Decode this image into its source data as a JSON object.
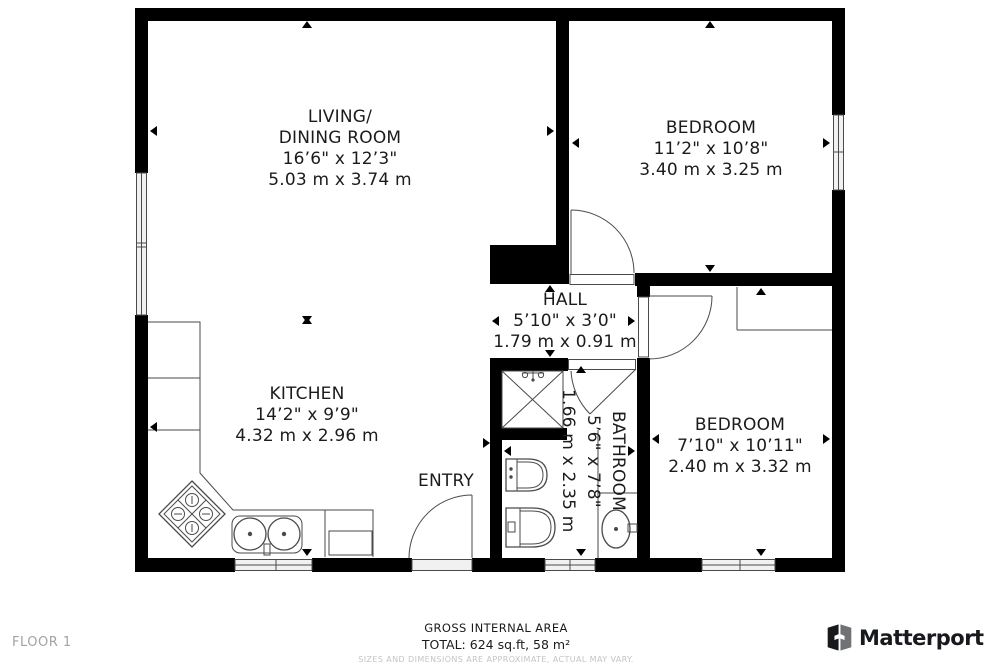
{
  "colors": {
    "bg": "#ffffff",
    "wall": "#000000",
    "line": "#4a4a4a",
    "window_fill": "#f1f1f1",
    "text": "#1b1b1b",
    "muted": "#a3a3a3",
    "disclaimer": "#c4c4c4",
    "logo_dark": "#17191d",
    "logo_gray": "#707276"
  },
  "rooms": {
    "living": {
      "line1": "LIVING/",
      "line2": "DINING ROOM",
      "imperial": "16’6\" x 12’3\"",
      "metric": "5.03 m x 3.74 m"
    },
    "bedroom_top": {
      "line1": "BEDROOM",
      "imperial": "11’2\" x 10’8\"",
      "metric": "3.40 m x 3.25 m"
    },
    "hall": {
      "line1": "HALL",
      "imperial": "5’10\" x 3’0\"",
      "metric": "1.79 m x 0.91 m"
    },
    "kitchen": {
      "line1": "KITCHEN",
      "imperial": "14’2\" x 9’9\"",
      "metric": "4.32 m x 2.96 m"
    },
    "bathroom": {
      "line1": "BATHROOM",
      "imperial": "5’6\" x 7’8\"",
      "metric": "1.66 m x 2.35 m"
    },
    "bedroom_bottom": {
      "line1": "BEDROOM",
      "imperial": "7’10\" x 10’11\"",
      "metric": "2.40 m x 3.32 m"
    },
    "entry": {
      "line1": "ENTRY"
    }
  },
  "footer": {
    "floor_label": "FLOOR 1",
    "area_title": "GROSS INTERNAL AREA",
    "area_total": "TOTAL: 624 sq.ft, 58 m²",
    "disclaimer": "SIZES AND DIMENSIONS ARE APPROXIMATE, ACTUAL MAY VARY.",
    "brand": "Matterport"
  }
}
